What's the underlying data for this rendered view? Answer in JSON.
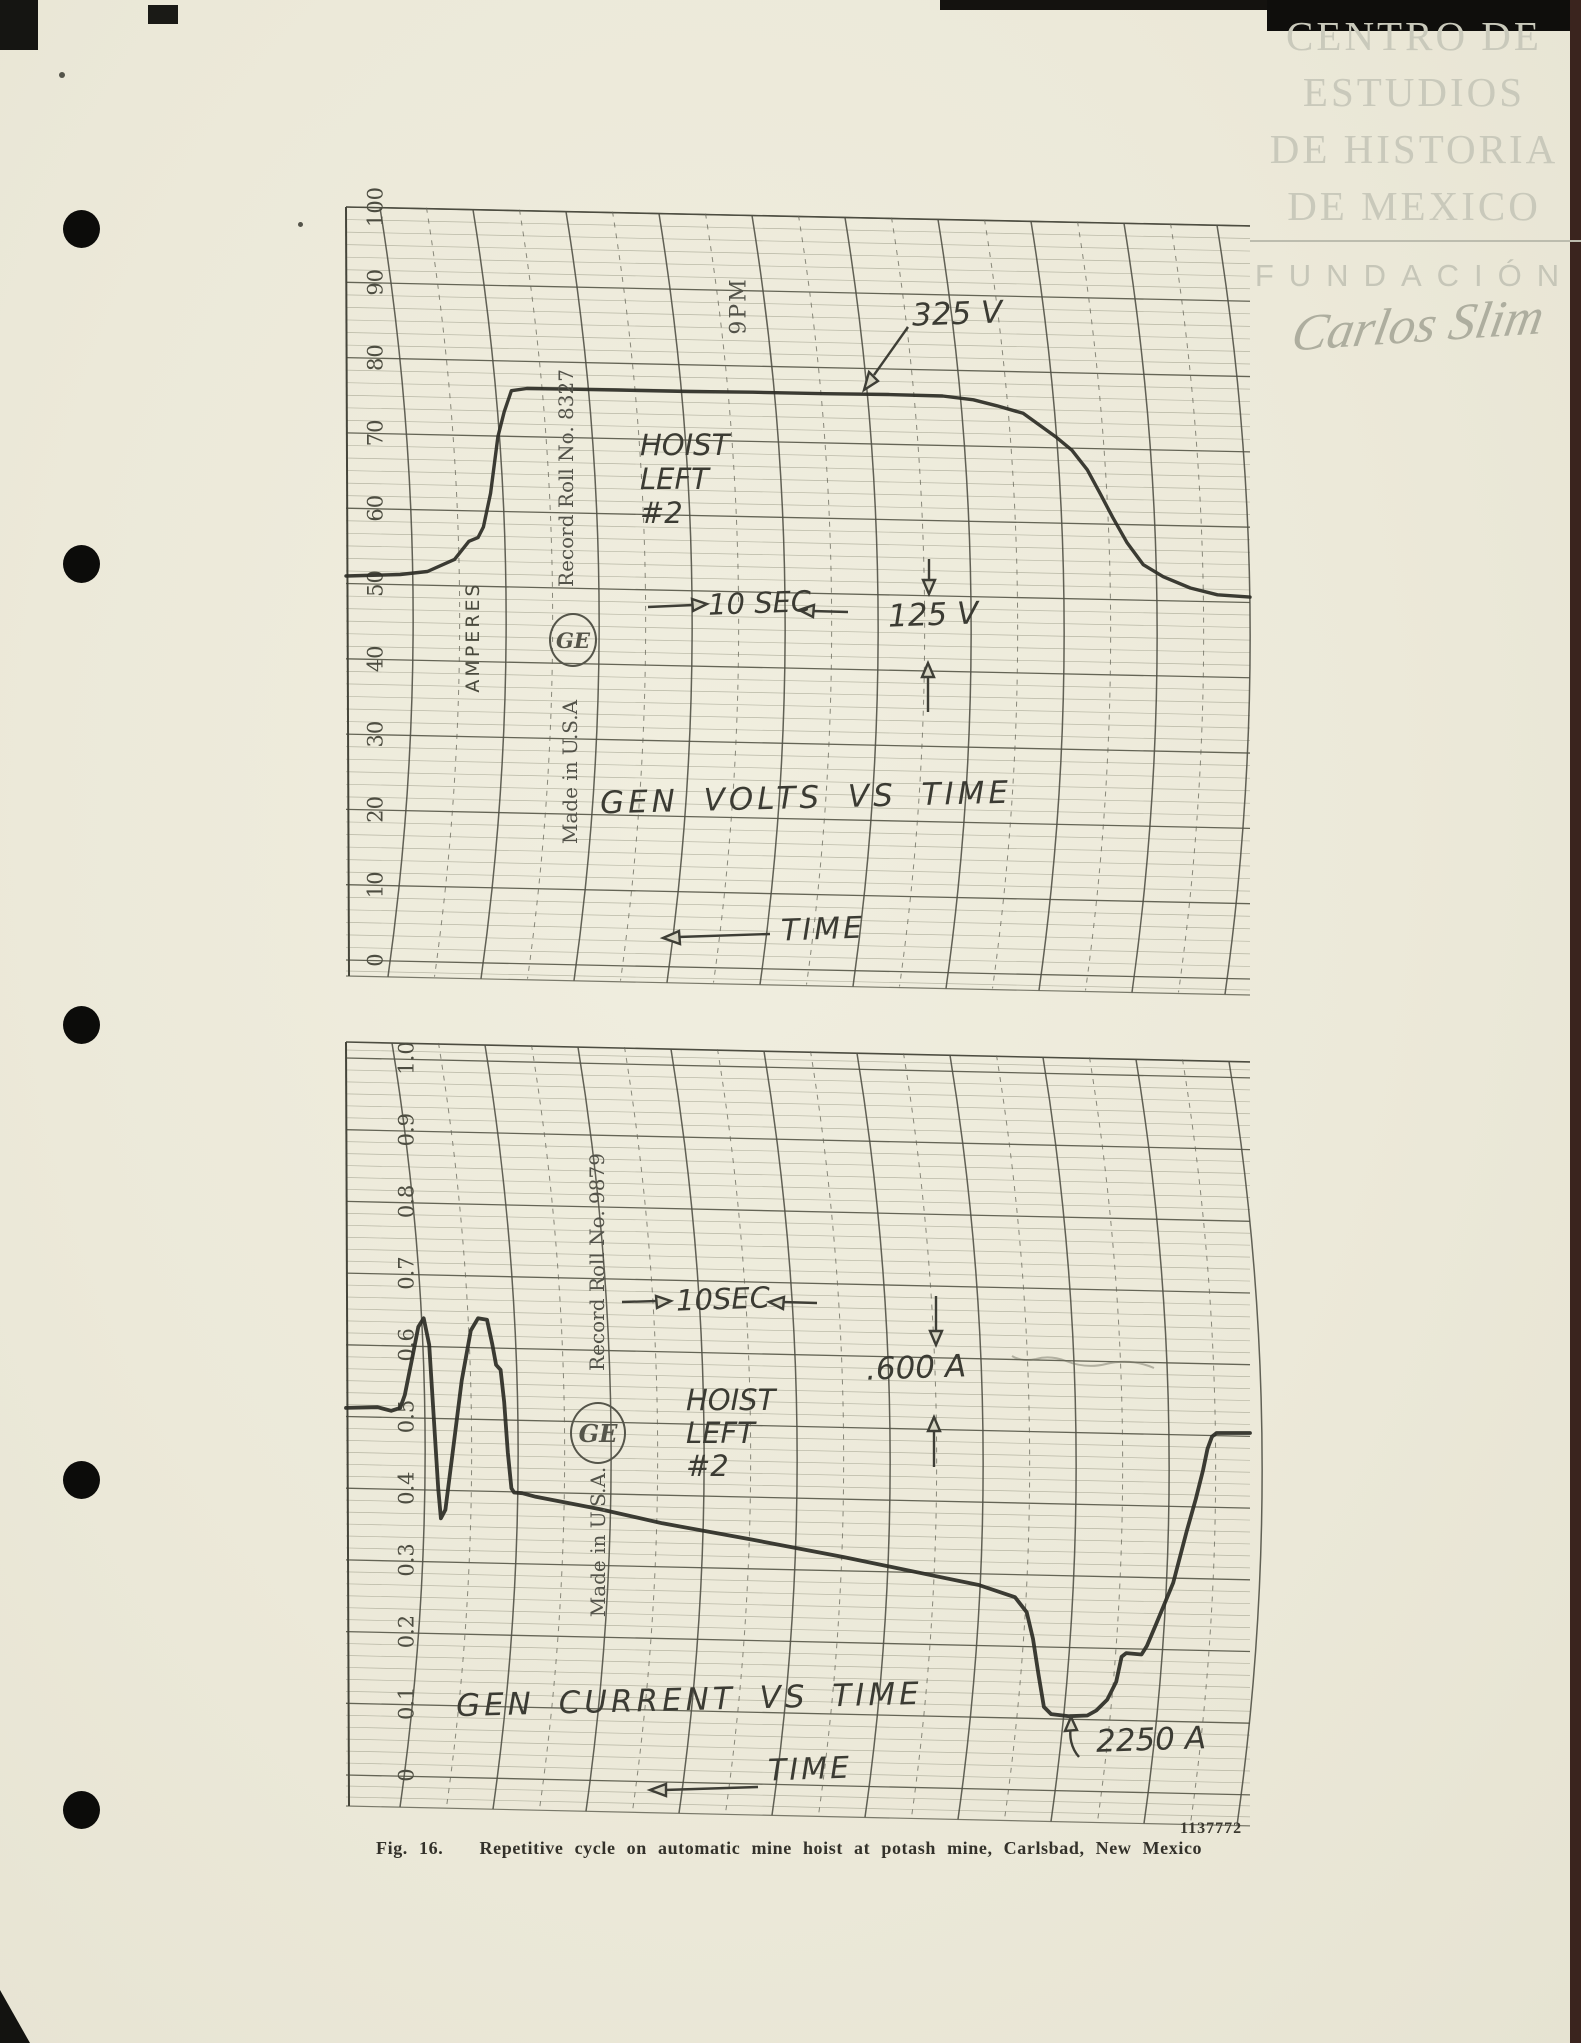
{
  "watermark": {
    "lines": [
      "CENTRO DE",
      "ESTUDIOS",
      "DE HISTORIA",
      "DE MEXICO"
    ],
    "foundation": "FUNDACIÓN",
    "signature": "Carlos Slim",
    "color": "#c9c9bb"
  },
  "caption": {
    "figure": "Fig. 16.",
    "text": "Repetitive cycle on automatic mine hoist at potash mine, Carlsbad, New Mexico",
    "print_number": "1137772"
  },
  "chart_data": [
    {
      "type": "line",
      "title": "GEN VOLTS VS TIME",
      "xlabel": "TIME",
      "ylabel": "AMPERES",
      "ylim": [
        0,
        100
      ],
      "grid": "ruled chart-recorder paper, curved time arcs",
      "legend_position": "none",
      "y_ticks": {
        "values": [
          100,
          90,
          80,
          70,
          60,
          50,
          40,
          30,
          20,
          10,
          0
        ],
        "labels": [
          "100",
          "90",
          "80",
          "70",
          "60",
          "50",
          "40",
          "30",
          "20",
          "10",
          "0"
        ]
      },
      "preprinted": {
        "record_roll": "Record Roll No. 8327",
        "made_in": "Made in U.S.A",
        "time_mark": "9PM",
        "logo": "GE"
      },
      "annotations": {
        "peak": "325 V",
        "hoist": [
          "HOIST",
          "LEFT",
          "#2"
        ],
        "interval": "10 SEC",
        "span": "125 V"
      },
      "series": [
        {
          "name": "generator volts trace",
          "x": [
            0,
            6,
            9,
            12,
            13.6,
            14.6,
            15.2,
            16,
            16.8,
            17.5,
            18.3,
            20,
            25,
            30,
            38,
            45,
            53,
            60,
            66,
            69.4,
            72,
            74.9,
            78.6,
            80.3,
            82,
            83.4,
            84.8,
            86.4,
            88.2,
            90.4,
            93.4,
            96.4,
            100
          ],
          "y": [
            51,
            51.2,
            51.6,
            53.2,
            55.6,
            56.1,
            57.5,
            62,
            69.5,
            72.8,
            75.6,
            75.9,
            75.8,
            75.7,
            75.5,
            75.4,
            75.2,
            75.1,
            74.9,
            74.4,
            73.6,
            72.6,
            69.4,
            67.7,
            65.1,
            62,
            58.8,
            55.4,
            52.5,
            50.9,
            49.4,
            48.5,
            48.2
          ]
        }
      ]
    },
    {
      "type": "line",
      "title": "GEN CURRENT VS TIME",
      "xlabel": "TIME",
      "ylabel": "",
      "ylim": [
        0,
        1.0
      ],
      "grid": "ruled chart-recorder paper, curved time arcs",
      "legend_position": "none",
      "y_ticks": {
        "values": [
          1.0,
          0.9,
          0.8,
          0.7,
          0.6,
          0.5,
          0.4,
          0.3,
          0.2,
          0.1,
          0
        ],
        "labels": [
          "1.0",
          "0.9",
          "0.8",
          "0.7",
          "0.6",
          "0.5",
          "0.4",
          "0.3",
          "0.2",
          "0.1",
          "0"
        ]
      },
      "preprinted": {
        "record_roll": "Record Roll No. 9879",
        "made_in": "Made in U.S.A.",
        "logo": "GE"
      },
      "annotations": {
        "interval": "10SEC",
        "span": ".600 A",
        "hoist": [
          "HOIST",
          "LEFT",
          "#2"
        ],
        "dip": "2250 A"
      },
      "series": [
        {
          "name": "generator current trace",
          "x": [
            0,
            3.5,
            5,
            6,
            6.5,
            7.3,
            8,
            8.6,
            9.2,
            9.7,
            10.2,
            10.5,
            11,
            11.8,
            12.8,
            13.8,
            14.6,
            15.6,
            16.2,
            16.6,
            17.1,
            17.5,
            17.9,
            18.3,
            18.6,
            19.5,
            21,
            28,
            35,
            45,
            55,
            65,
            70,
            74,
            75.3,
            76,
            76.6,
            77.2,
            78,
            80,
            82,
            83,
            84.2,
            85.2,
            85.8,
            86.3,
            88,
            88.6,
            89.6,
            91.5,
            93,
            94,
            94.8,
            95.3,
            95.8,
            96.3,
            100
          ],
          "y": [
            0.512,
            0.513,
            0.508,
            0.512,
            0.53,
            0.58,
            0.625,
            0.637,
            0.6,
            0.5,
            0.4,
            0.358,
            0.37,
            0.45,
            0.55,
            0.62,
            0.637,
            0.635,
            0.6,
            0.572,
            0.565,
            0.52,
            0.45,
            0.4,
            0.394,
            0.393,
            0.388,
            0.371,
            0.351,
            0.328,
            0.304,
            0.278,
            0.265,
            0.248,
            0.227,
            0.19,
            0.14,
            0.095,
            0.085,
            0.082,
            0.083,
            0.09,
            0.105,
            0.13,
            0.165,
            0.17,
            0.168,
            0.18,
            0.21,
            0.268,
            0.34,
            0.385,
            0.425,
            0.455,
            0.472,
            0.477,
            0.477
          ]
        }
      ]
    }
  ]
}
